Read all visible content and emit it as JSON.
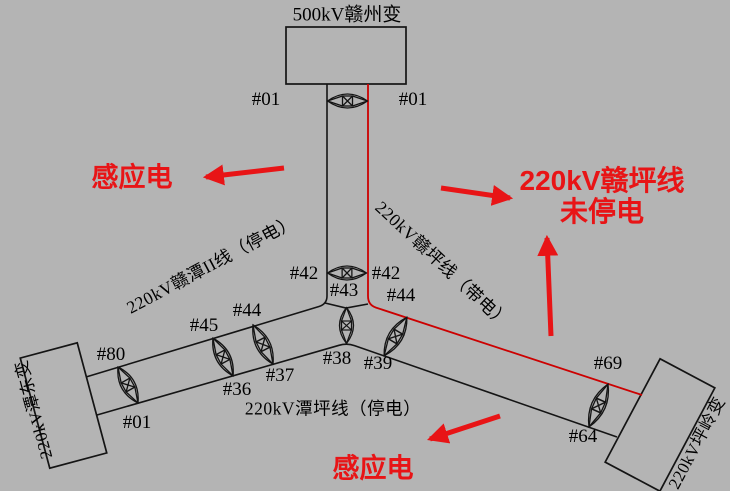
{
  "canvas": {
    "width": 730,
    "height": 491,
    "background": "#b4b4b4"
  },
  "colors": {
    "diagram_ink": "#141414",
    "energized_line_red": "#cc0000",
    "annotation_red": "#e81416"
  },
  "stations": {
    "ganzhou": "500kV赣州变",
    "tandong": "220kV潭东变",
    "pingling": "220kV坪岭变"
  },
  "lines": {
    "gantan2": "220kV赣潭II线（停电）",
    "ganping": "220kV赣坪线（带电）",
    "tanping": "220kV潭坪线（停电）"
  },
  "annotations": {
    "induced_left": "感应电",
    "induced_bottom": "感应电",
    "warning_line1": "220kV赣坪线",
    "warning_line2": "未停电"
  },
  "towers": [
    {
      "label": "#01",
      "x": 266,
      "y": 100
    },
    {
      "label": "#01",
      "x": 413,
      "y": 100
    },
    {
      "label": "#42",
      "x": 304,
      "y": 274
    },
    {
      "label": "#42",
      "x": 386,
      "y": 274
    },
    {
      "label": "#43",
      "x": 344,
      "y": 291
    },
    {
      "label": "#44",
      "x": 401,
      "y": 296
    },
    {
      "label": "#38",
      "x": 337,
      "y": 359
    },
    {
      "label": "#39",
      "x": 378,
      "y": 364
    },
    {
      "label": "#44",
      "x": 247,
      "y": 311
    },
    {
      "label": "#45",
      "x": 204,
      "y": 326
    },
    {
      "label": "#37",
      "x": 280,
      "y": 376
    },
    {
      "label": "#36",
      "x": 237,
      "y": 390
    },
    {
      "label": "#80",
      "x": 111,
      "y": 355
    },
    {
      "label": "#01",
      "x": 137,
      "y": 423
    },
    {
      "label": "#69",
      "x": 608,
      "y": 364
    },
    {
      "label": "#64",
      "x": 583,
      "y": 437
    }
  ]
}
